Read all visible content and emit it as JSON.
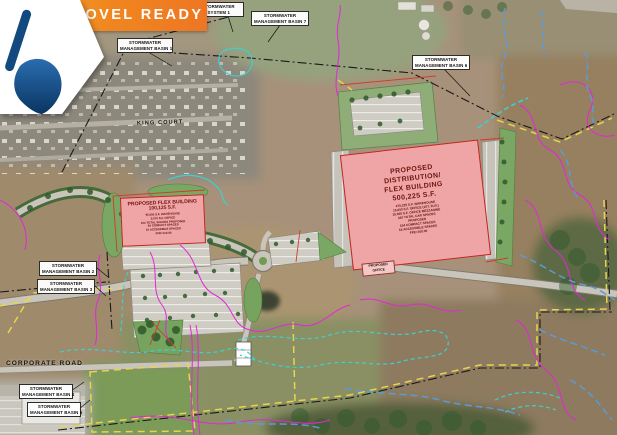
{
  "banner": {
    "label": "SHOVEL READY"
  },
  "logo": {
    "icon": "shovel-icon"
  },
  "roads": {
    "king_court": "KING COURT",
    "corporate_road": "CORPORATE ROAD"
  },
  "callouts": {
    "detention1": {
      "line1": "PROPOSED STORMWATER",
      "line2": "DETENTION SYSTEM 1"
    },
    "basin1": {
      "line1": "STORMWATER",
      "line2": "MANAGEMENT BASIN 1"
    },
    "basin2": {
      "line1": "STORMWATER",
      "line2": "MANAGEMENT BASIN 2"
    },
    "basin3": {
      "line1": "STORMWATER",
      "line2": "MANAGEMENT BASIN 3"
    },
    "basin4": {
      "line1": "STORMWATER",
      "line2": "MANAGEMENT BASIN 4"
    },
    "basin5": {
      "line1": "STORMWATER",
      "line2": "MANAGEMENT BASIN 5"
    },
    "basin6": {
      "line1": "STORMWATER",
      "line2": "MANAGEMENT BASIN 6"
    },
    "basin7": {
      "line1": "STORMWATER",
      "line2": "MANAGEMENT BASIN 7"
    }
  },
  "buildings": {
    "flex": {
      "title": "PROPOSED FLEX BUILDING",
      "size": "100,125 S.F.",
      "details": [
        "95,050 S.F. WAREHOUSE",
        "5,075 S.F. OFFICE",
        "104 TOTAL SPACES PROPOSED",
        "94 COMPACT SPACES",
        "10 ACCESSIBLE SPACES",
        "FFE=110.00"
      ]
    },
    "distribution": {
      "line1": "PROPOSED",
      "line2": "DISTRIBUTION/",
      "line3": "FLEX BUILDING",
      "line4": "500,225 S.F.",
      "details": [
        "470,225 S.F. WAREHOUSE",
        "15,000 S.F. OFFICE (1ST. FLR.)",
        "15,000 S.F. OFFICE MEZZANINE",
        "316 TOTAL CAR SPACES",
        "PROPOSED",
        "154 COMPACT SPACES",
        "18 ACCESSIBLE SPACES",
        "FFE=105.00"
      ]
    },
    "office": {
      "line1": "PROPOSED",
      "line2": "OFFICE"
    }
  },
  "colors": {
    "banner_orange": "#ee7623",
    "building_pink": "#efa5a5",
    "building_border_red": "#c0261f",
    "contour_magenta": "#e326d8",
    "boundary_yellow": "#e8d44f",
    "stream_blue": "#5b9bd5",
    "wetland_teal": "#3ecfcf",
    "shovel_blue": "#14497f"
  }
}
